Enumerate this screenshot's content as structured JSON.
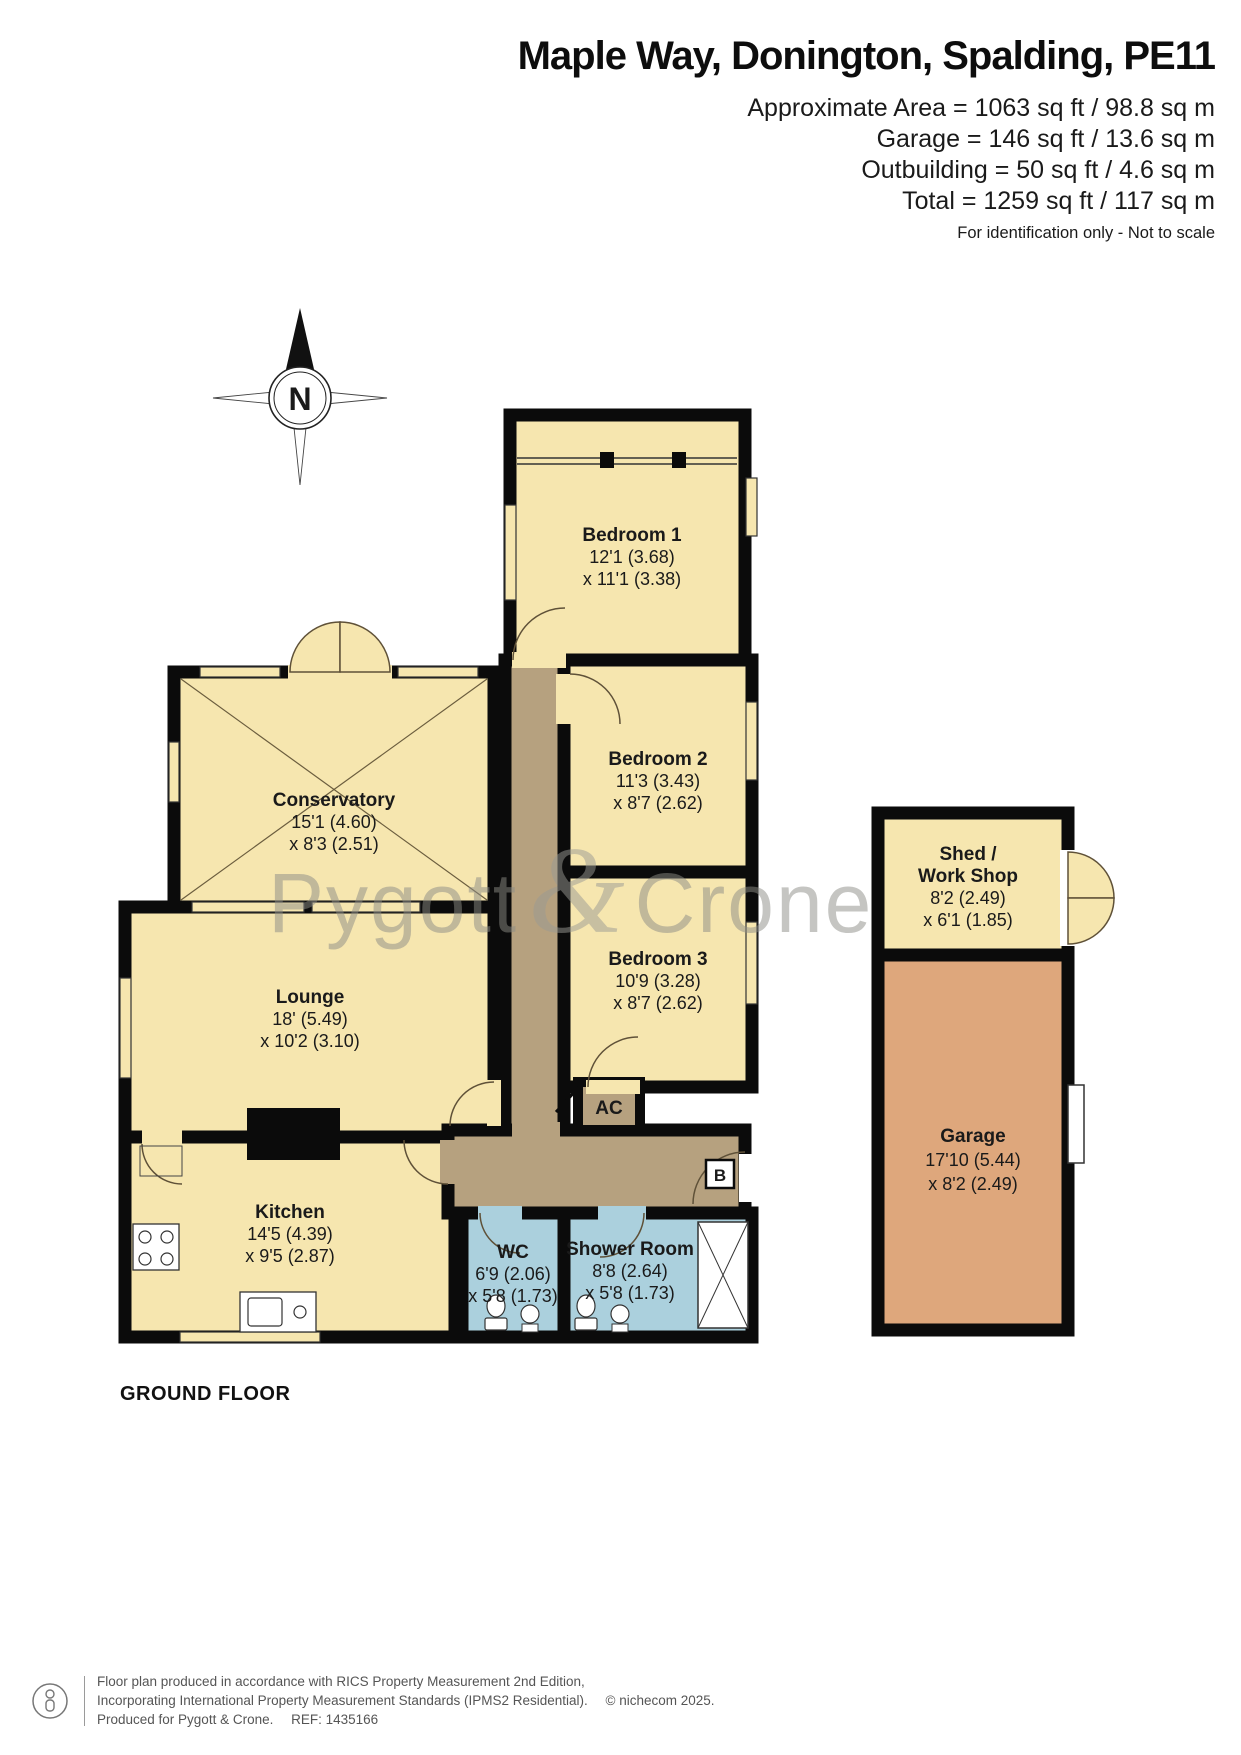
{
  "header": {
    "title": "Maple Way, Donington, Spalding, PE11",
    "area_lines": [
      "Approximate Area = 1063 sq ft / 98.8 sq m",
      "Garage = 146 sq ft / 13.6 sq m",
      "Outbuilding = 50 sq ft / 4.6 sq m",
      "Total = 1259 sq ft / 117 sq m"
    ],
    "note": "For identification only - Not to scale"
  },
  "compass": {
    "label": "N"
  },
  "watermark": {
    "part1": "Pygott",
    "amp": "&",
    "part2": "Crone"
  },
  "rooms": {
    "bedroom1": {
      "name": "Bedroom 1",
      "dim1": "12'1 (3.68)",
      "dim2": "x 11'1 (3.38)"
    },
    "bedroom2": {
      "name": "Bedroom 2",
      "dim1": "11'3 (3.43)",
      "dim2": "x 8'7 (2.62)"
    },
    "bedroom3": {
      "name": "Bedroom 3",
      "dim1": "10'9 (3.28)",
      "dim2": "x 8'7 (2.62)"
    },
    "conservatory": {
      "name": "Conservatory",
      "dim1": "15'1 (4.60)",
      "dim2": "x 8'3 (2.51)"
    },
    "lounge": {
      "name": "Lounge",
      "dim1": "18' (5.49)",
      "dim2": "x 10'2 (3.10)"
    },
    "kitchen": {
      "name": "Kitchen",
      "dim1": "14'5 (4.39)",
      "dim2": "x 9'5 (2.87)"
    },
    "wc": {
      "name": "WC",
      "dim1": "6'9 (2.06)",
      "dim2": "x 5'8 (1.73)"
    },
    "shower": {
      "name": "Shower Room",
      "dim1": "8'8 (2.64)",
      "dim2": "x 5'8 (1.73)"
    },
    "shed": {
      "name1": "Shed /",
      "name2": "Work Shop",
      "dim1": "8'2 (2.49)",
      "dim2": "x 6'1 (1.85)"
    },
    "garage": {
      "name": "Garage",
      "dim1": "17'10 (5.44)",
      "dim2": "x 8'2 (2.49)"
    },
    "ac": "AC",
    "boiler": "B"
  },
  "floor_label": "GROUND FLOOR",
  "footer": {
    "line1": "Floor plan produced in accordance with RICS Property Measurement 2nd Edition,",
    "line2": "Incorporating International Property Measurement Standards (IPMS2 Residential).",
    "copyright": "© nichecom 2025.",
    "line3": "Produced for Pygott & Crone.",
    "ref": "REF: 1435166"
  },
  "colors": {
    "room_yellow": "#F6E6AF",
    "hall_brown": "#B6A17F",
    "wet_blue": "#ABD0DD",
    "garage_orange": "#DEA77C",
    "wall_black": "#0B0B0B"
  }
}
